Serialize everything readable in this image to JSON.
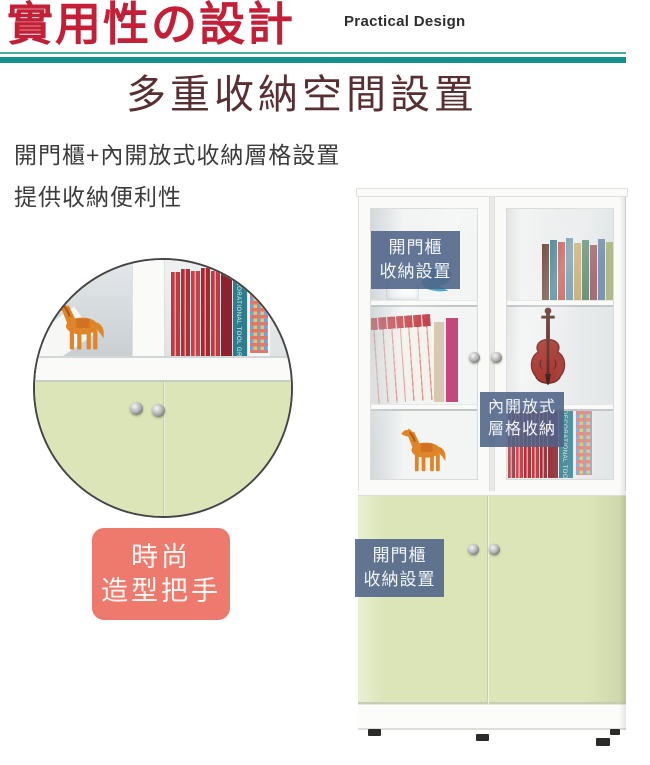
{
  "header": {
    "title": "實用性の設計",
    "title_color": "#C32038",
    "subtitle_en": "Practical Design",
    "rule_color": "#17918B"
  },
  "section": {
    "heading": "多重收納空間設置",
    "heading_color": "#5A2F33",
    "description_lines": [
      "開門櫃+內開放式收納層格設置",
      "提供收納便利性"
    ]
  },
  "callouts": {
    "bg_color": "#51648A",
    "text_color": "#FFFFFF",
    "top_door": {
      "lines": [
        "開門櫃",
        "收納設置"
      ]
    },
    "inner_shelf": {
      "lines": [
        "內開放式",
        "層格收納"
      ]
    },
    "bottom_door": {
      "lines": [
        "開門櫃",
        "收納設置"
      ]
    },
    "handle_badge": {
      "lines": [
        "時尚",
        "造型把手"
      ],
      "bg_color": "#EE7A6E"
    }
  },
  "photo": {
    "book_spine_text": "DECORATIONAL TOOL GRAPH",
    "door_color_green": "#DBE5B8",
    "items": [
      "teal-bird-figurine",
      "acrylic-box",
      "book-rows",
      "red-violin",
      "orange-horse-figurine",
      "silver-door-knobs"
    ]
  }
}
